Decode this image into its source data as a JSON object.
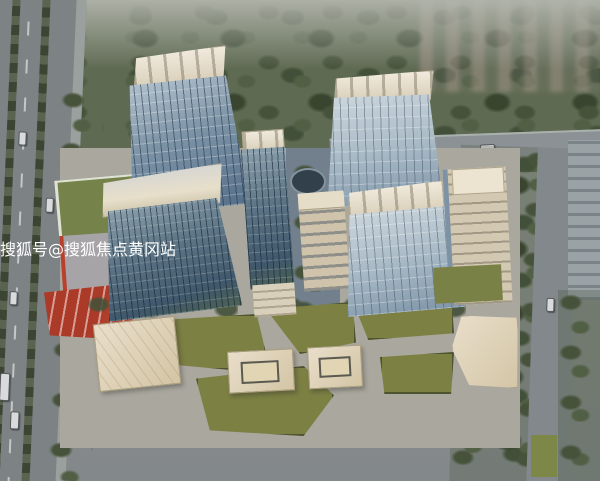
{
  "image": {
    "description": "Aerial rendering of a mixed-use residential and commercial complex with eight numbered buildings",
    "width": 600,
    "height": 481
  },
  "markers": {
    "shape": "circle",
    "fill_color": "#c5251e",
    "text_color": "#ffffff",
    "items": [
      {
        "label": "1",
        "x": 185,
        "y": 93,
        "d": 30
      },
      {
        "label": "2",
        "x": 95,
        "y": 182,
        "d": 30
      },
      {
        "label": "3",
        "x": 172,
        "y": 222,
        "d": 30
      },
      {
        "label": "4",
        "x": 268,
        "y": 164,
        "d": 30
      },
      {
        "label": "5",
        "x": 388,
        "y": 110,
        "d": 30
      },
      {
        "label": "6",
        "x": 322,
        "y": 209,
        "d": 26
      },
      {
        "label": "7",
        "x": 400,
        "y": 204,
        "d": 30
      },
      {
        "label": "8",
        "x": 478,
        "y": 212,
        "d": 30
      }
    ]
  },
  "watermark": {
    "text": "搜狐号@搜狐焦点黄冈站",
    "color": "#ffffff",
    "outline_color": "#000000"
  }
}
